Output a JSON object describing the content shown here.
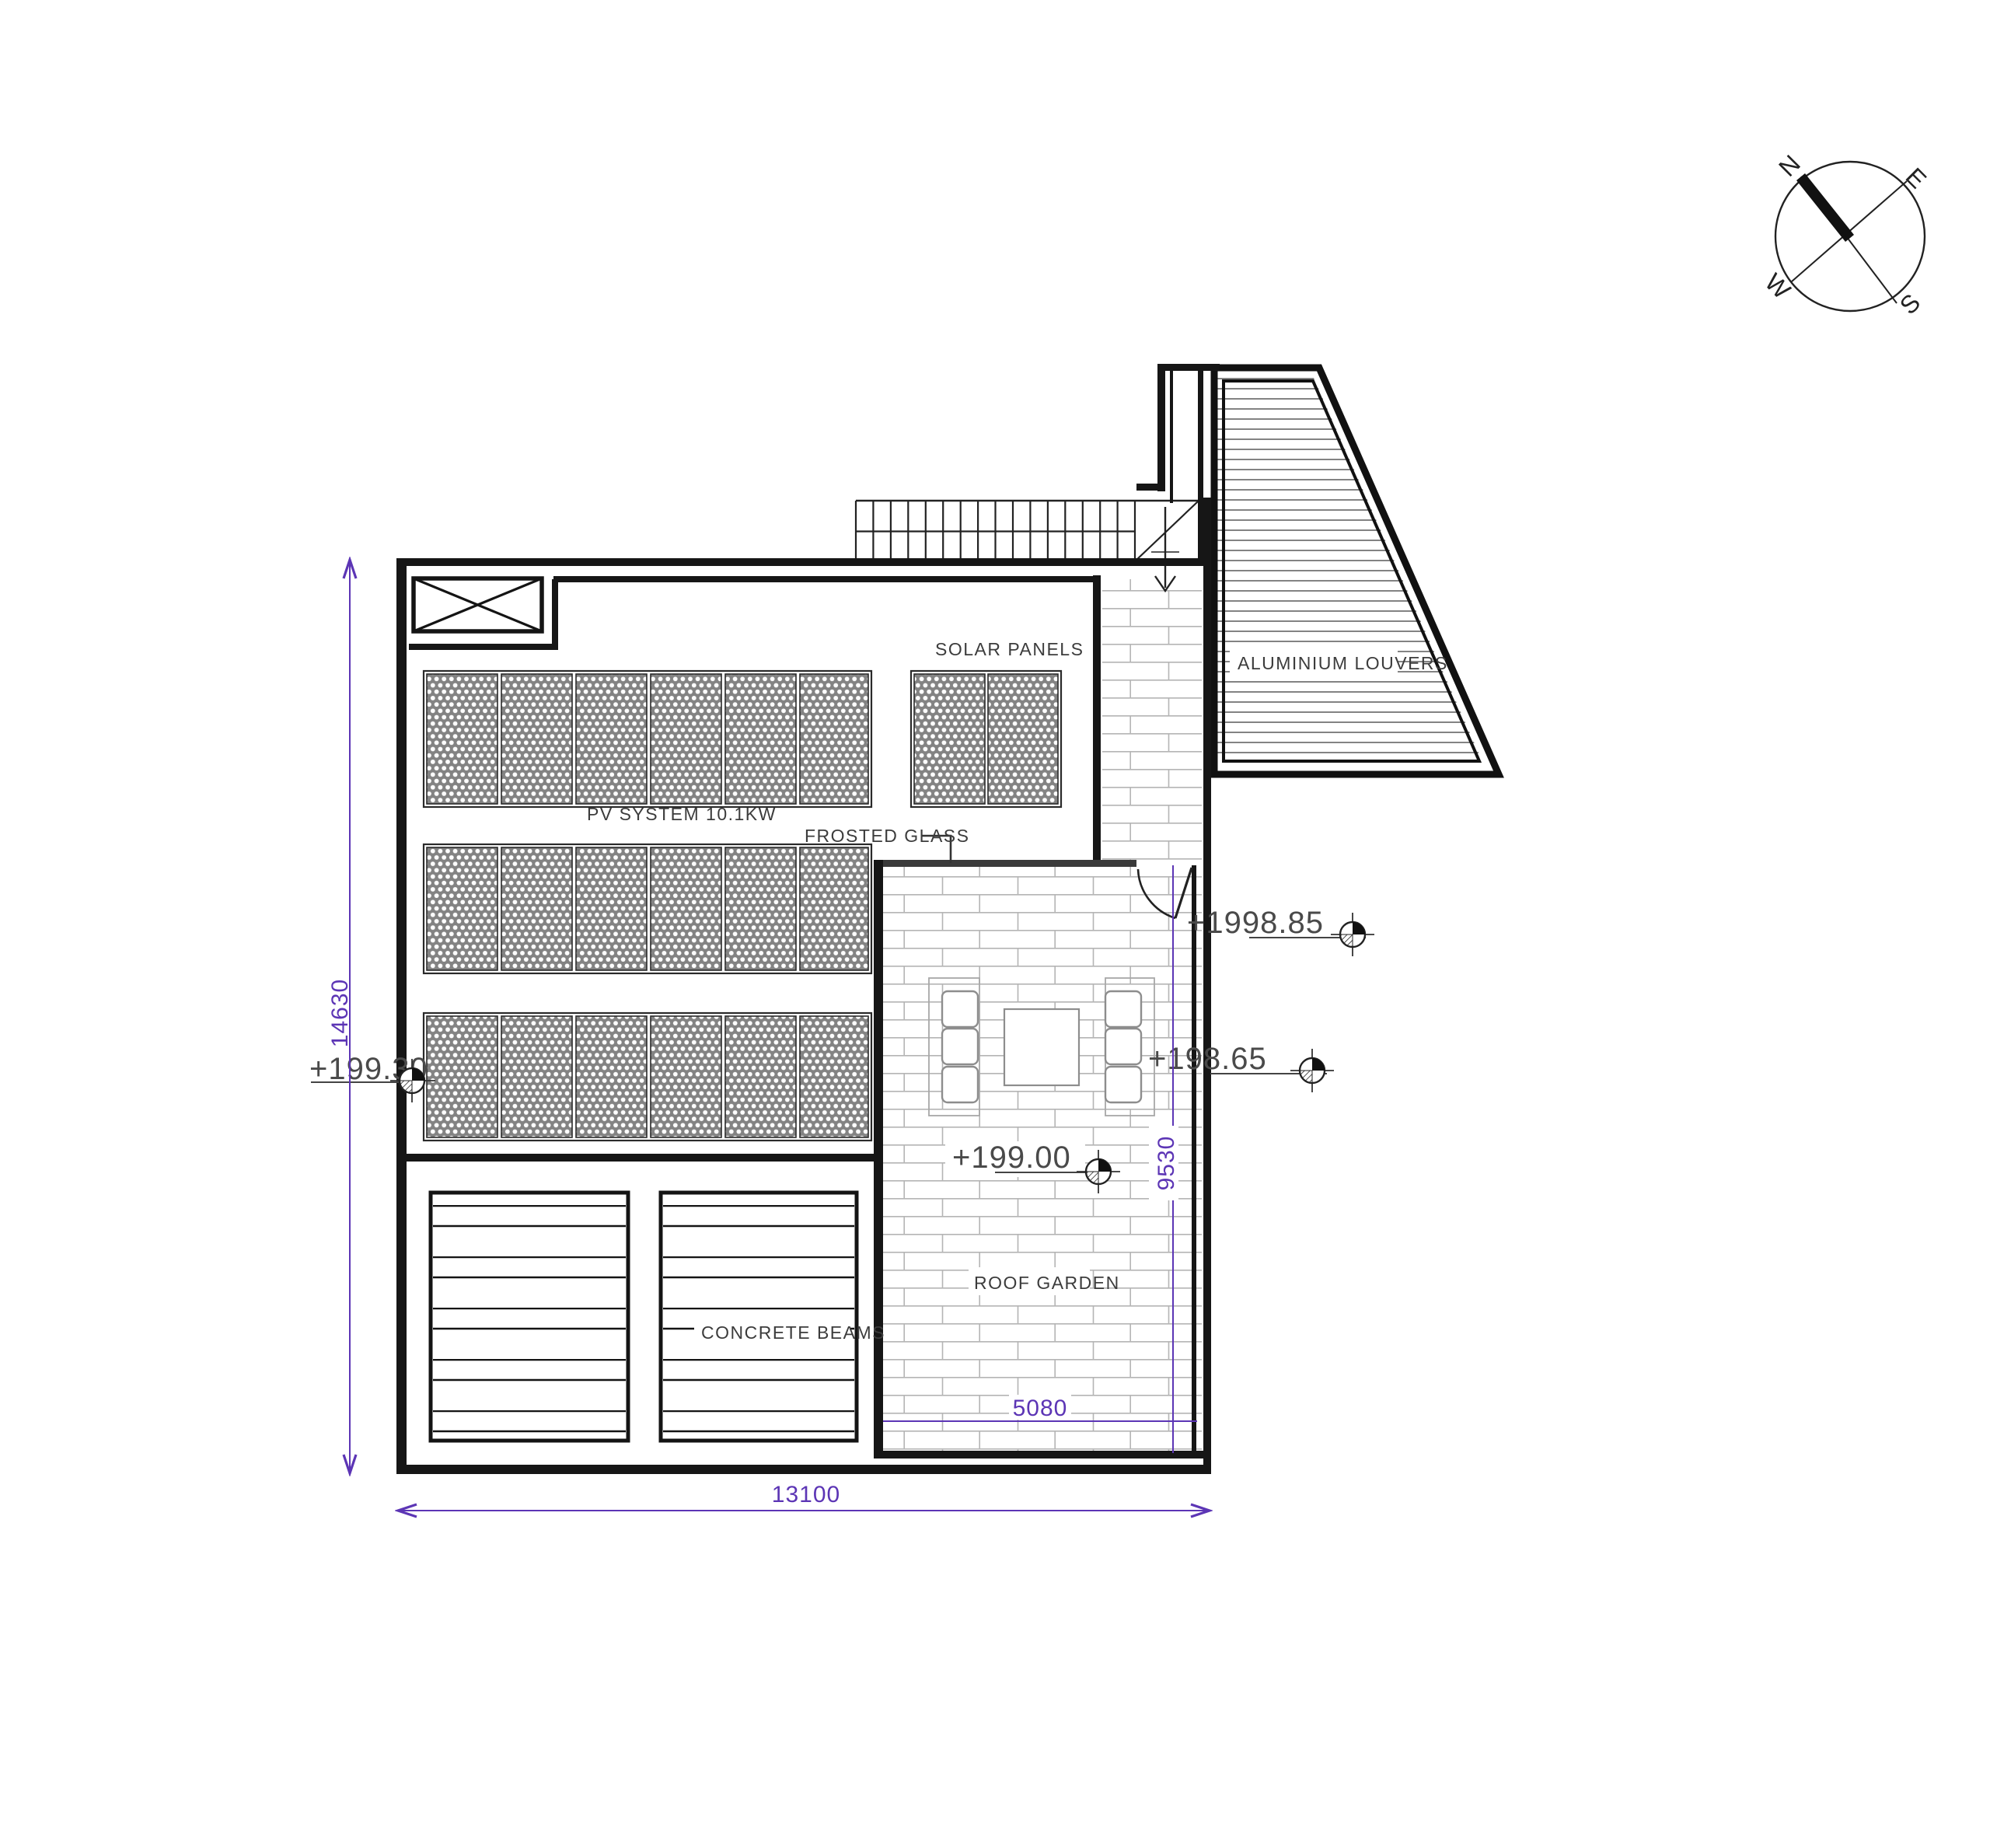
{
  "drawing": {
    "title_hint": "roof plan",
    "labels": {
      "solar_panels": "SOLAR PANELS",
      "pv_system": "PV SYSTEM 10.1KW",
      "frosted_glass": "FROSTED GLASS",
      "aluminium_louvers": "ALUMINIUM LOUVERS",
      "concrete_beams": "CONCRETE BEAMS",
      "roof_garden": "ROOF GARDEN"
    },
    "elevations": {
      "left": "+199.30",
      "top_right": "+1998.85",
      "mid_right": "+198.65",
      "garden": "+199.00"
    },
    "dimensions": {
      "total_height": "14630",
      "total_width": "13100",
      "garden_height": "9530",
      "garden_width": "5080"
    },
    "compass": {
      "n": "N",
      "e": "E",
      "s": "S",
      "w": "W"
    },
    "colors": {
      "line": "#161616",
      "dimension": "#5c35b5",
      "label": "#3c3c3c",
      "brick": "#b5b5b5",
      "panel_fill": "#838383"
    }
  }
}
